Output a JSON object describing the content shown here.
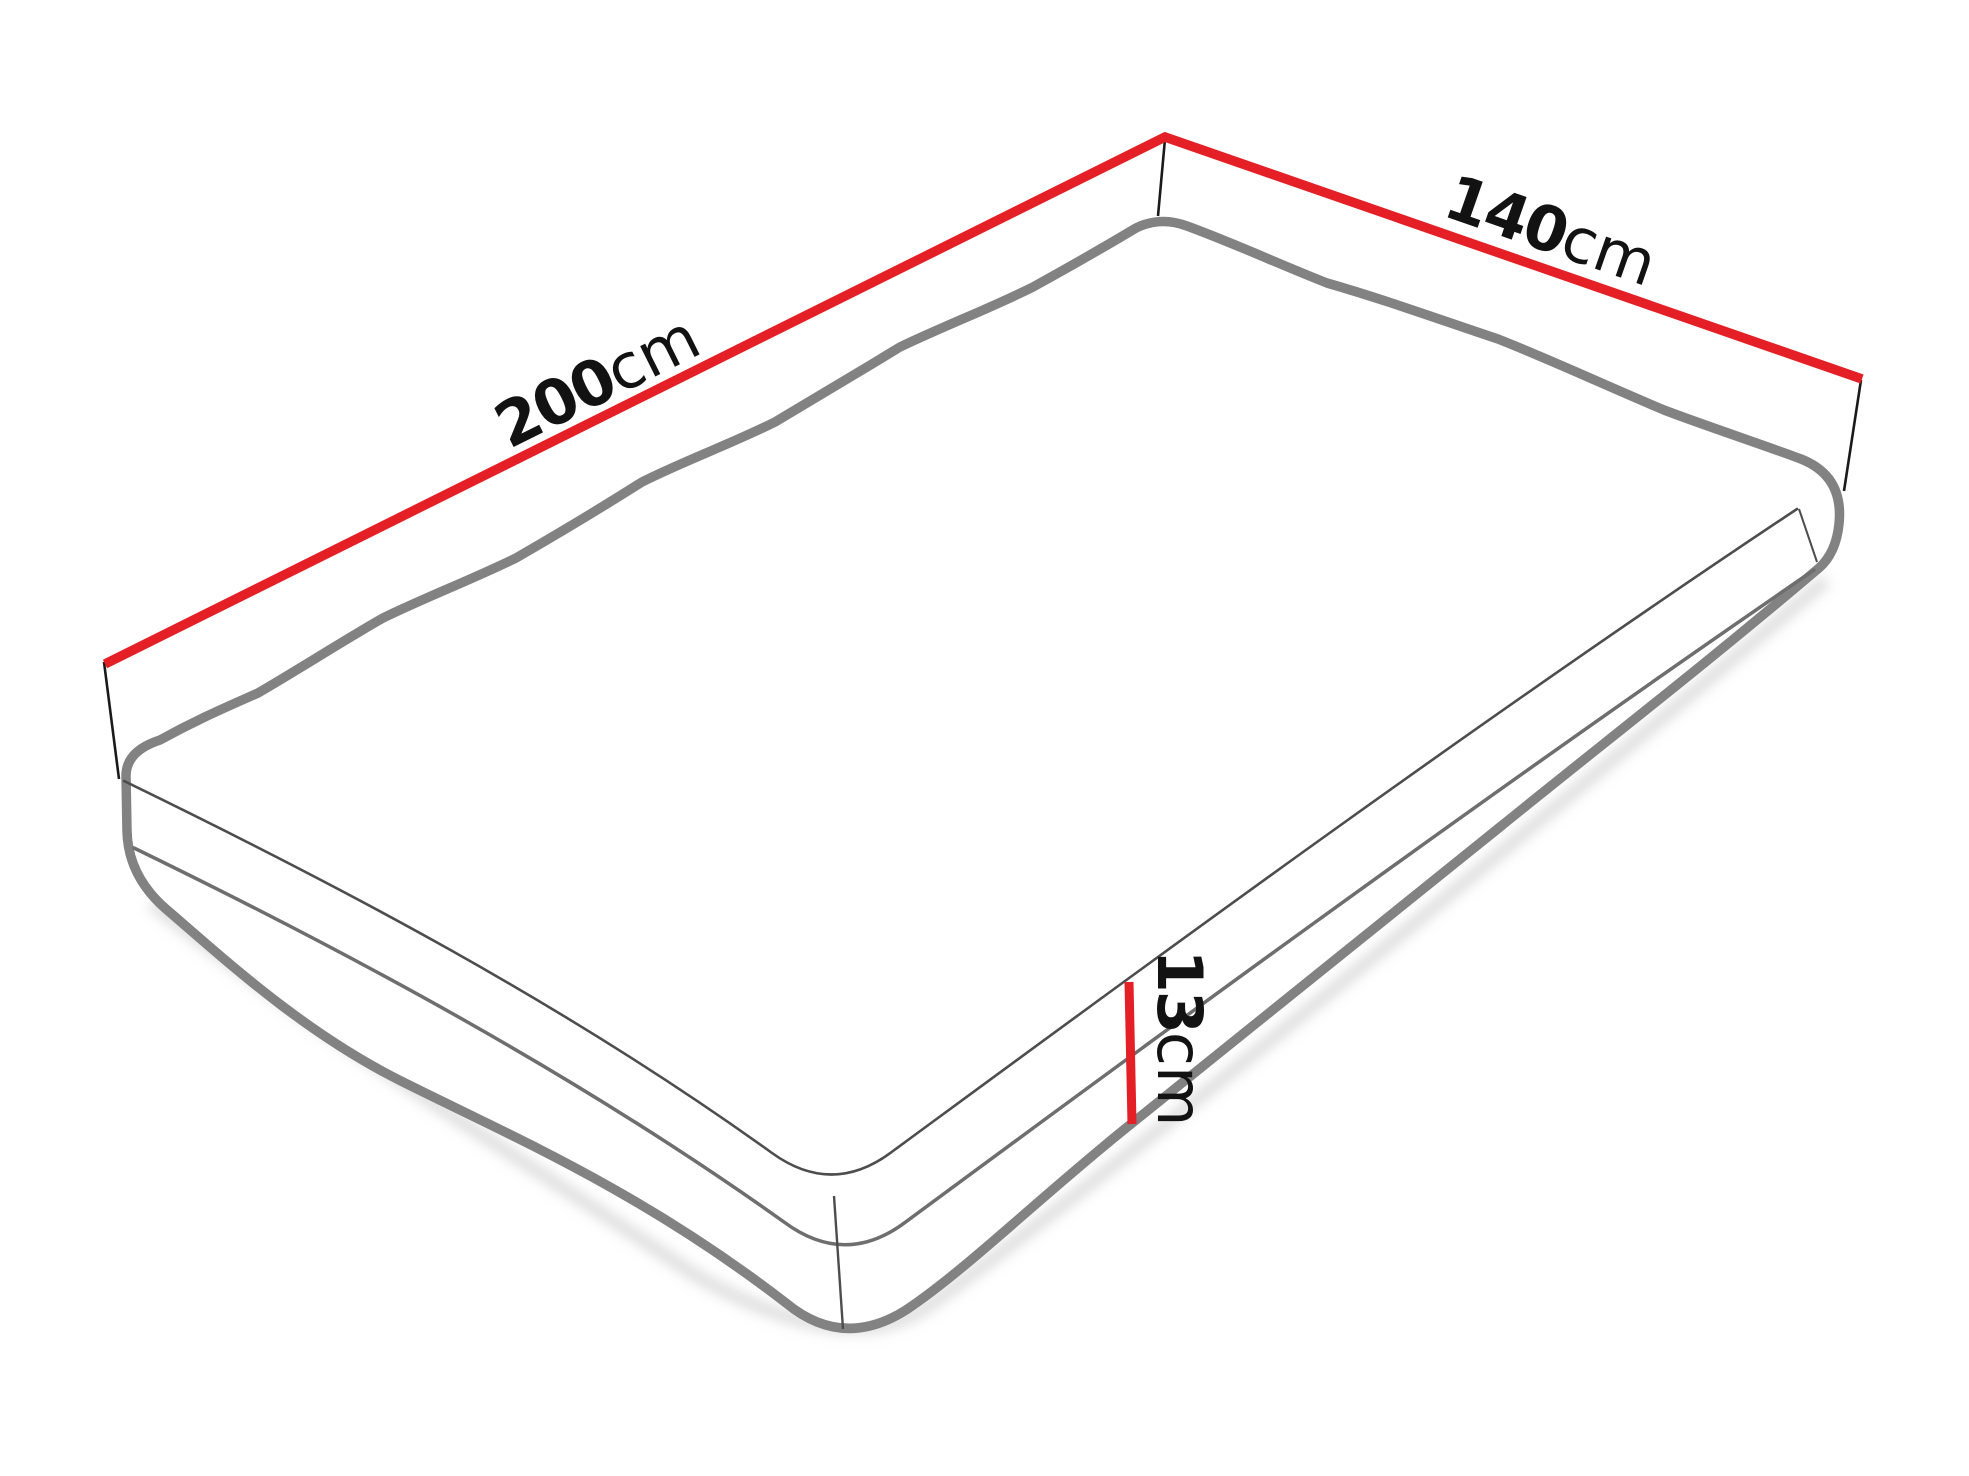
{
  "diagram": {
    "description": "Mattress isometric outline drawing with dimension lines",
    "labels": {
      "length": {
        "number": "200",
        "unit": "cm"
      },
      "width": {
        "number": "140",
        "unit": "cm"
      },
      "height": {
        "number": "13",
        "unit": "cm"
      }
    },
    "colors": {
      "dimension_line": "#e51f26",
      "outline": "#828282",
      "top_edge": "#4d4d4d",
      "piping": "#6e6e6e",
      "tick": "#1a1a1a",
      "text": "#121212",
      "shadow": "#c9c9c9",
      "background": "#ffffff"
    }
  }
}
